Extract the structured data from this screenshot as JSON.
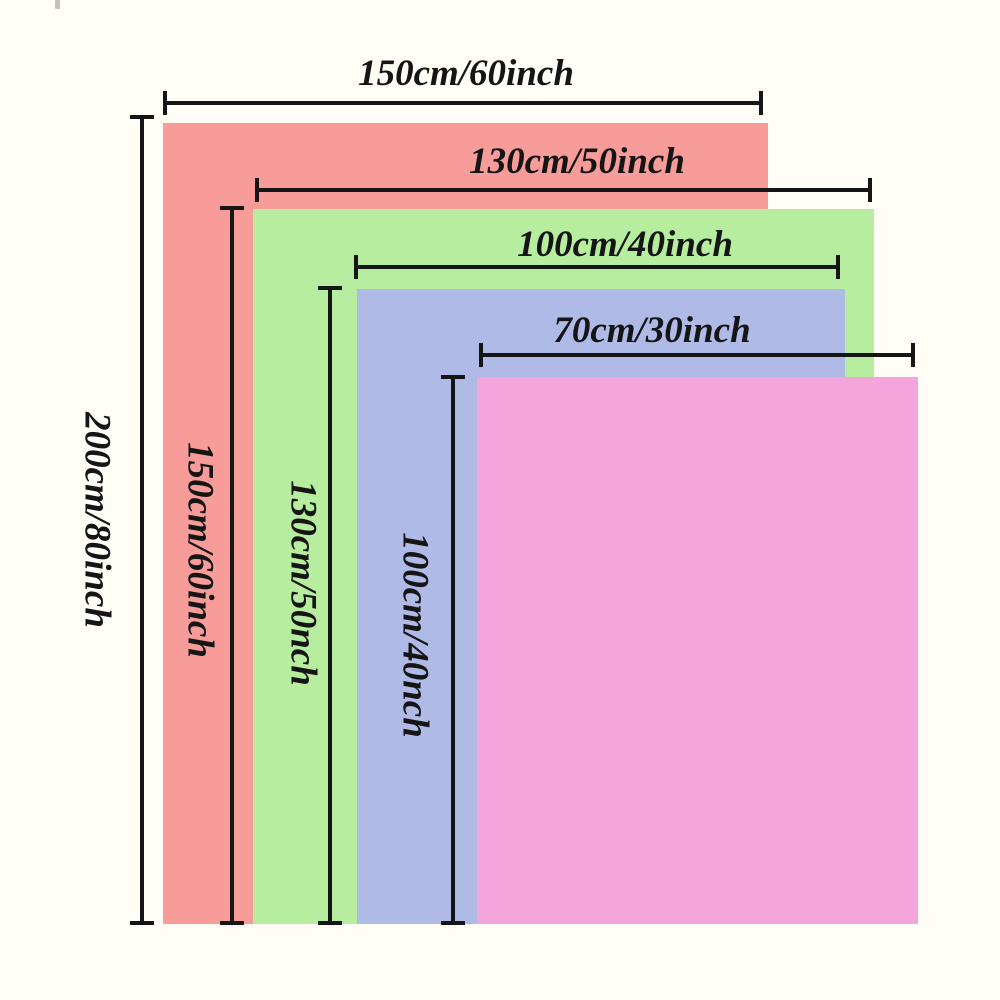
{
  "page": {
    "background": "#FFFDF6",
    "ink": "#151515"
  },
  "layers": [
    {
      "id": "red",
      "fill": "#F89C99",
      "width_label": "150cm/60inch",
      "height_label": "200cm/80inch"
    },
    {
      "id": "green",
      "fill": "#B7ED9E",
      "width_label": "130cm/50inch",
      "height_label": "150cm/60inch"
    },
    {
      "id": "blue",
      "fill": "#AFBAE7",
      "width_label": "100cm/40inch",
      "height_label": "130cm/50nch"
    },
    {
      "id": "pink",
      "fill": "#F3A5DC",
      "width_label": "70cm/30inch",
      "height_label": "100cm/40nch"
    }
  ]
}
